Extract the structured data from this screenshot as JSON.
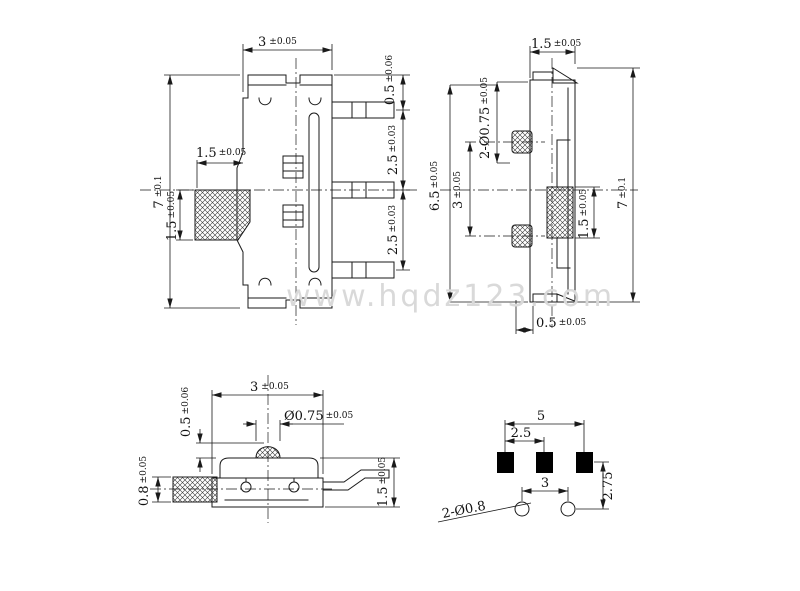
{
  "watermark": "www.hqdz123.com",
  "colors": {
    "line": "#1a1a1a",
    "watermark": "#d9d9d9",
    "pad_fill": "#000000"
  },
  "views": {
    "front": {
      "dim_width": {
        "v": "3",
        "t": "±0.05"
      },
      "dim_height": {
        "v": "7",
        "t": "±0.1"
      },
      "dim_knob_length": {
        "v": "1.5",
        "t": "±0.05"
      },
      "dim_knob_height": {
        "v": "1.5",
        "t": "±0.05"
      },
      "dim_top_offset": {
        "v": "0.5",
        "t": "±0.06"
      },
      "dim_pitch_upper": {
        "v": "2.5",
        "t": "±0.03"
      },
      "dim_pitch_lower": {
        "v": "2.5",
        "t": "±0.03"
      }
    },
    "side": {
      "dim_width": {
        "v": "1.5",
        "t": "±0.05"
      },
      "dim_pegs": {
        "v": "2-Ø0.75",
        "t": "±0.05"
      },
      "dim_span": {
        "v": "6.5",
        "t": "±0.05"
      },
      "dim_peg_pitch": {
        "v": "3",
        "t": "±0.05"
      },
      "dim_knob_height": {
        "v": "1.5",
        "t": "±0.05"
      },
      "dim_height": {
        "v": "7",
        "t": "±0.1"
      },
      "dim_tab_offset": {
        "v": "0.5",
        "t": "±0.05"
      }
    },
    "top": {
      "dim_width": {
        "v": "3",
        "t": "±0.05"
      },
      "dim_peg_height": {
        "v": "0.5",
        "t": "±0.06"
      },
      "dim_peg_diameter": {
        "v": "Ø0.75",
        "t": "±0.05"
      },
      "dim_knob_width": {
        "v": "0.8",
        "t": "±0.05"
      },
      "dim_body_height": {
        "v": "1.5",
        "t": "±0.05"
      }
    },
    "pcb": {
      "dim_outer_pitch": "5",
      "dim_pad_pitch": "2.5",
      "dim_hole_pitch": "3",
      "dim_row_gap": "2.75",
      "dim_holes": "2-Ø0.8"
    }
  }
}
